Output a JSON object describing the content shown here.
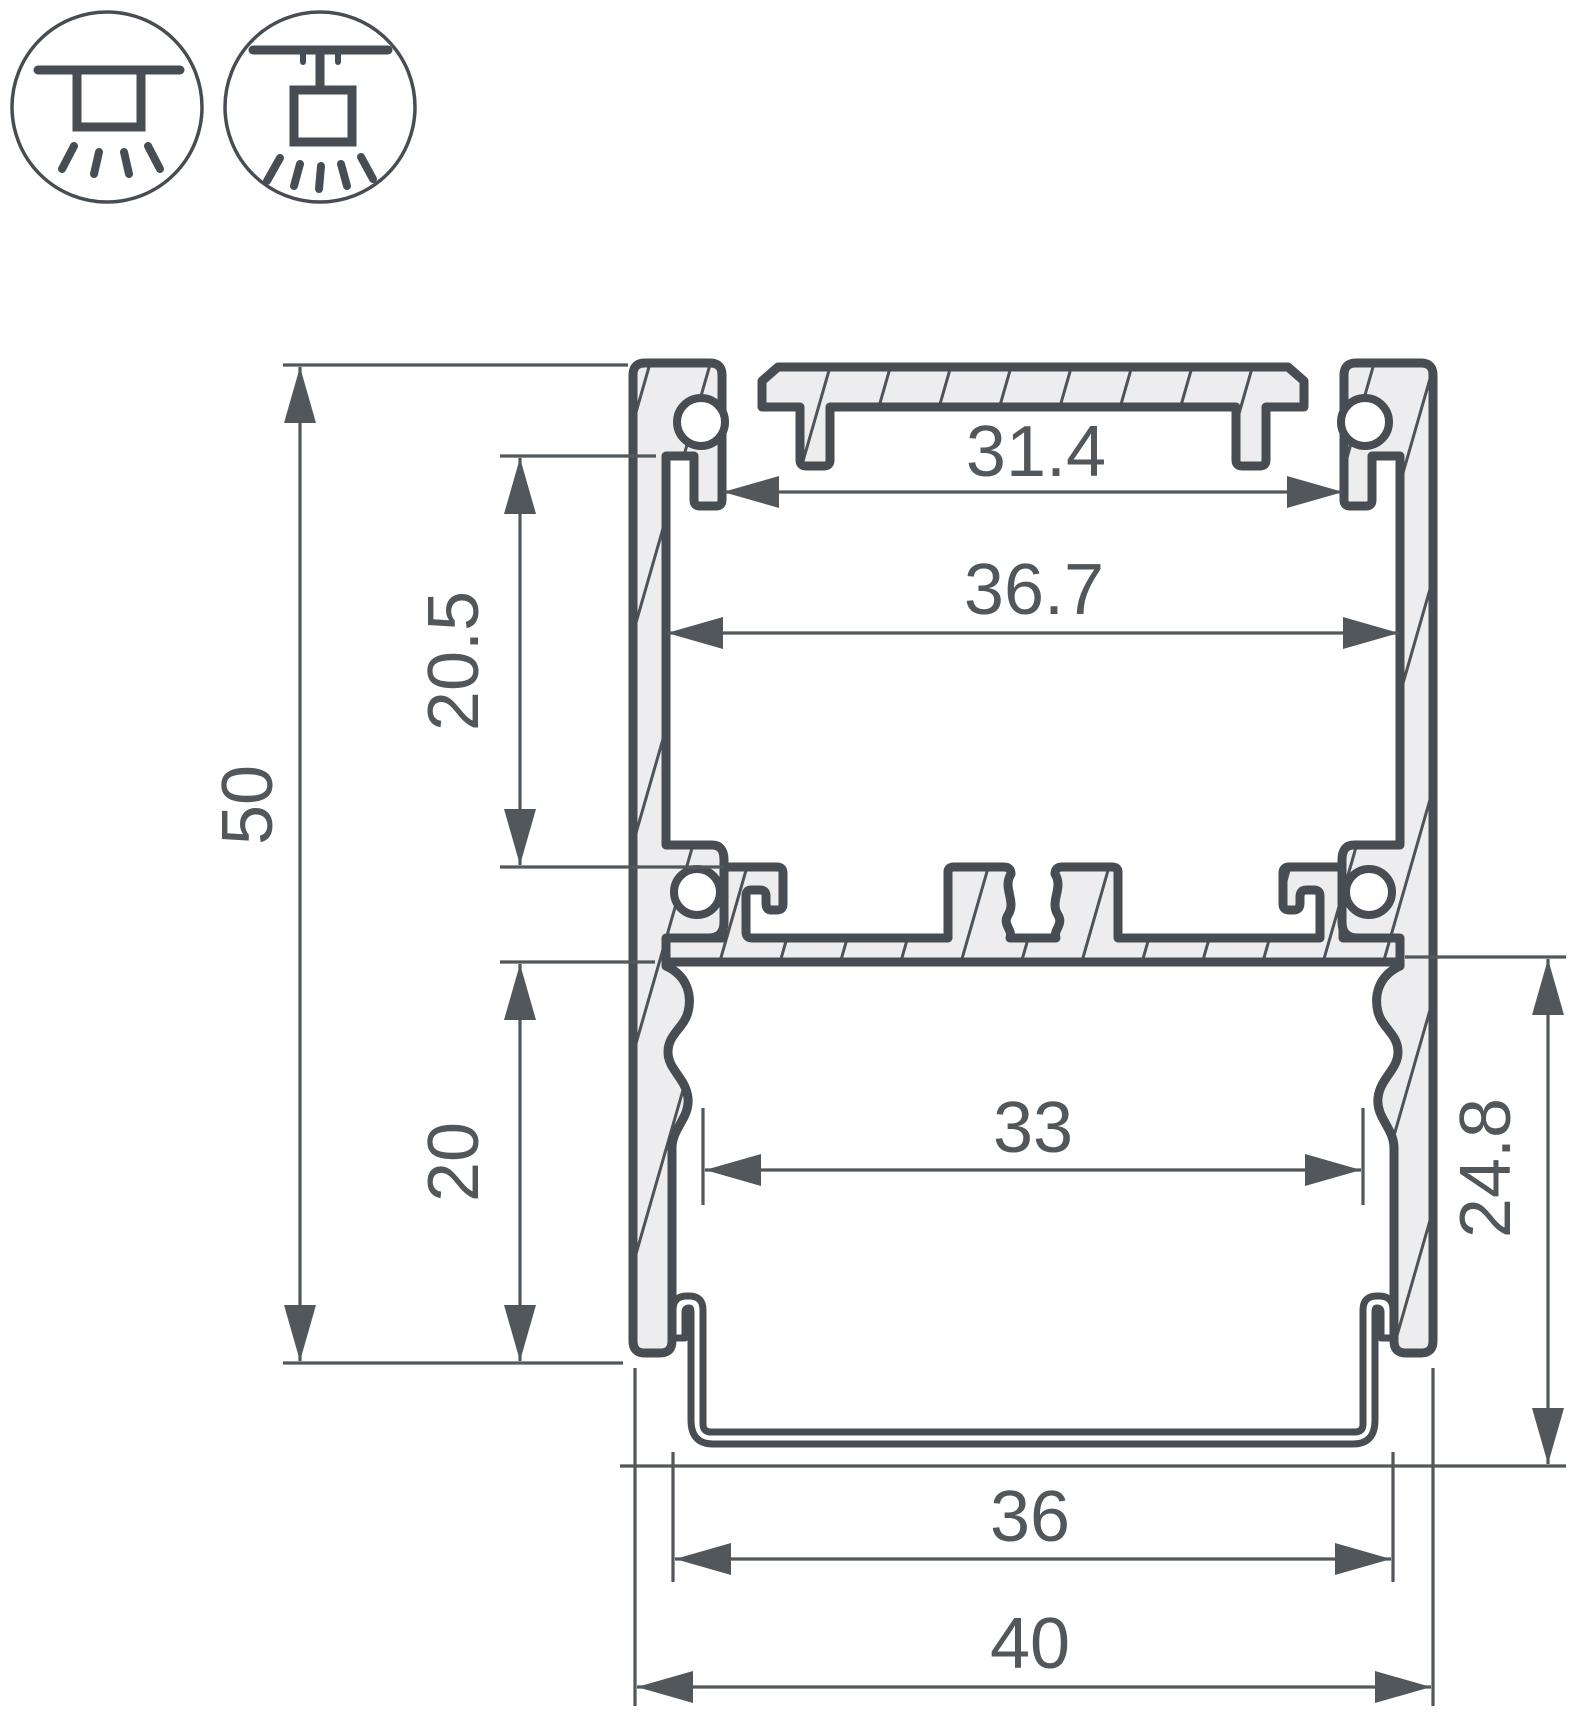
{
  "drawing_type": "led-profile-cross-section",
  "colors": {
    "outline": "#474d52",
    "aluminum_fill": "#ededef",
    "dimension": "#52575c",
    "background": "#ffffff"
  },
  "icons": [
    {
      "name": "surface-mount-icon"
    },
    {
      "name": "pendant-mount-icon"
    }
  ],
  "dimensions": {
    "top_slot_width": "31.4",
    "inner_width": "36.7",
    "upper_cavity_height": "20.5",
    "overall_height": "50",
    "lower_inner_width": "33",
    "lower_cavity_height": "20",
    "diffuser_drop_height": "24.8",
    "diffuser_width": "36",
    "overall_width": "40"
  }
}
